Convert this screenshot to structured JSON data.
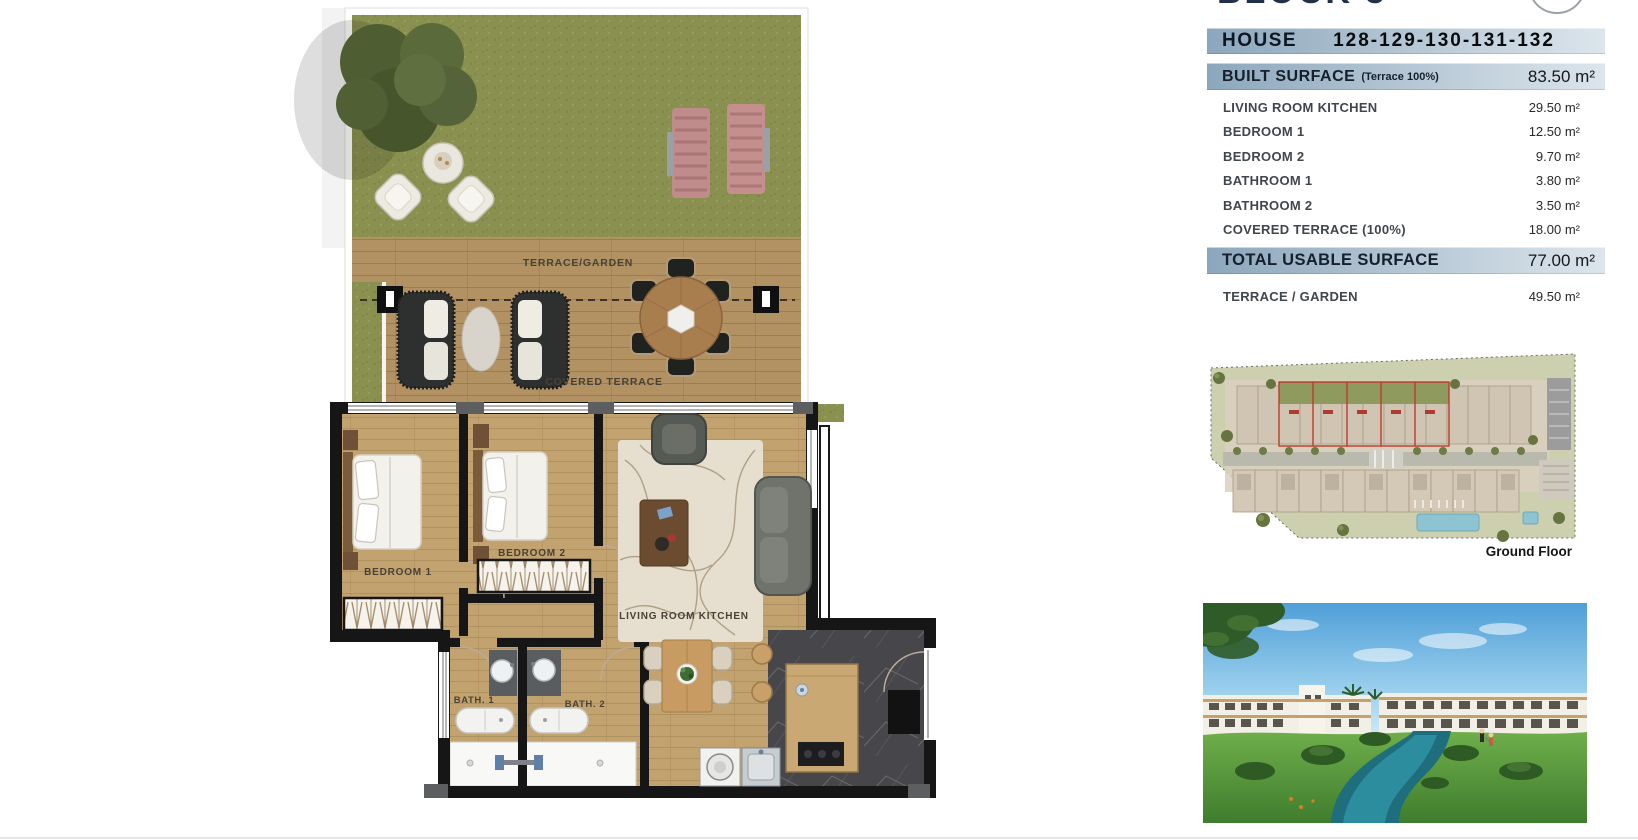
{
  "header": {
    "block_title": "BLOCK 3"
  },
  "floor_plan": {
    "labels": {
      "terrace_garden": "TERRACE/GARDEN",
      "covered_terrace": "COVERED TERRACE",
      "bedroom_1": "BEDROOM 1",
      "bedroom_2": "BEDROOM 2",
      "living_room_kitchen": "LIVING ROOM KITCHEN",
      "bath_1": "BATH. 1",
      "bath_2": "BATH. 2"
    }
  },
  "panel": {
    "house": {
      "label": "HOUSE",
      "numbers": "128-129-130-131-132"
    },
    "built_surface": {
      "label": "BUILT SURFACE",
      "note": "(Terrace 100%)",
      "value": "83.50 m²"
    },
    "rooms": [
      {
        "label": "LIVING ROOM KITCHEN",
        "value": "29.50 m²"
      },
      {
        "label": "BEDROOM 1",
        "value": "12.50 m²"
      },
      {
        "label": "BEDROOM 2",
        "value": "9.70 m²"
      },
      {
        "label": "BATHROOM 1",
        "value": "3.80 m²"
      },
      {
        "label": "BATHROOM 2",
        "value": "3.50 m²"
      },
      {
        "label": "COVERED TERRACE (100%)",
        "value": "18.00 m²"
      }
    ],
    "total": {
      "label": "TOTAL USABLE SURFACE",
      "value": "77.00 m²"
    },
    "terrace_garden": {
      "label": "TERRACE / GARDEN",
      "value": "49.50 m²"
    },
    "site_plan": {
      "caption": "Ground Floor"
    }
  },
  "colors": {
    "bar_left": "#8CA7BC",
    "bar_right": "#DCE5EC",
    "grass": "#8A9150",
    "deck": "#B29263",
    "floor": "#C2A36F",
    "wall": "#161616",
    "marble": "#47474B",
    "highlight_red": "#C0392B"
  }
}
